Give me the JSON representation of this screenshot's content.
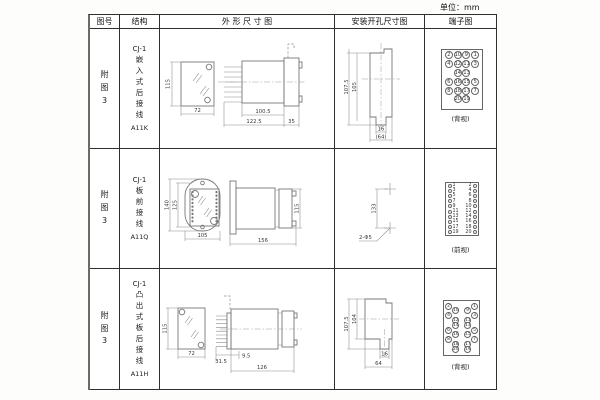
{
  "unit_label": "单位：mm",
  "header": {
    "fig_no": "图号",
    "structure": "结构",
    "outline": "外 形 尺 寸 图",
    "mounting": "安装开孔尺寸图",
    "terminal": "端子图"
  },
  "rows": [
    {
      "fig_no": "附\n图\n3",
      "series": "CJ-1",
      "structure": "嵌\n入\n式\n后\n接\n线",
      "model": "A11K",
      "outline": {
        "front_h": "115",
        "front_w": "72",
        "depth": "100.5",
        "total": "122.5",
        "panel": "35"
      },
      "mounting": {
        "v_outer": "107.5",
        "v_inner": "105",
        "tab": "16",
        "width": "(64)"
      },
      "terminal_view": "(背视)"
    },
    {
      "fig_no": "附\n图\n3",
      "series": "CJ-1",
      "structure": "板\n前\n接\n线",
      "model": "A11Q",
      "outline": {
        "front_h_outer": "140",
        "front_h_inner": "125",
        "front_w": "105",
        "depth": "156",
        "side_h": "115"
      },
      "mounting": {
        "spacing": "133",
        "holes": "2-Φ5"
      },
      "terminal_view": "(前视)"
    },
    {
      "fig_no": "附\n图\n3",
      "series": "CJ-1",
      "structure": "凸\n出\n式\n板\n后\n接\n线",
      "model": "A11H",
      "outline": {
        "front_h": "115",
        "front_w": "72",
        "pin_len": "31.5",
        "gap": "9.5",
        "depth": "126"
      },
      "mounting": {
        "v_outer": "107.5",
        "v_inner": "104",
        "tab": "16",
        "width": "64"
      },
      "terminal_view": "(背视)"
    }
  ],
  "terminals": {
    "grid_back": {
      "rows": [
        [
          "2",
          "10",
          "9",
          "1"
        ],
        [
          "4",
          "12",
          "11",
          "3"
        ],
        [
          "",
          "14",
          "13",
          ""
        ],
        [
          "6",
          "16",
          "15",
          "5"
        ],
        [
          "8",
          "18",
          "17",
          "7"
        ],
        [
          "",
          "20",
          "19",
          ""
        ]
      ]
    },
    "strip_front": {
      "rows": [
        [
          "1",
          "2"
        ],
        [
          "3",
          "4"
        ],
        [
          "5",
          "6"
        ],
        [
          "7",
          "8"
        ],
        [
          "9",
          "10"
        ],
        [
          "11",
          "12"
        ],
        [
          "13",
          "14"
        ],
        [
          "15",
          "16"
        ],
        [
          "17",
          "18"
        ],
        [
          "19",
          "20"
        ]
      ]
    },
    "zigzag_back": {
      "left": [
        "2",
        "10",
        "4",
        "12",
        "14",
        "6",
        "16",
        "8",
        "18",
        "20"
      ],
      "right": [
        "1",
        "9",
        "3",
        "11",
        "13",
        "5",
        "15",
        "7",
        "17",
        "19"
      ],
      "offsets": [
        0,
        1,
        0,
        1,
        1,
        0,
        1,
        0,
        1,
        1
      ]
    }
  }
}
